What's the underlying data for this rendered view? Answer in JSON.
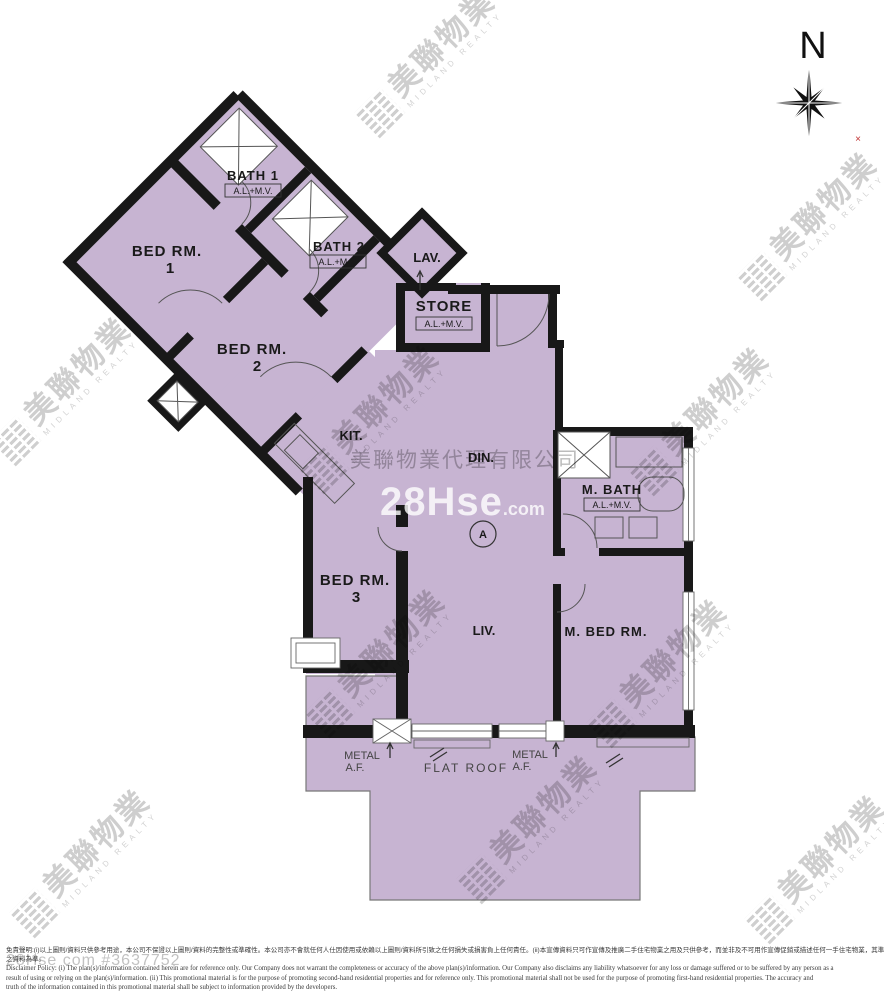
{
  "colors": {
    "floor_fill": "#c7b4d2",
    "wall": "#181818",
    "thin_line": "#555555",
    "watermark_gray": "#c6c6c6"
  },
  "compass": {
    "north_label": "N",
    "corner_mark": "×"
  },
  "rooms": {
    "bed1": {
      "name": "BED RM.",
      "number": "1"
    },
    "bed2": {
      "name": "BED RM.",
      "number": "2"
    },
    "bed3": {
      "name": "BED RM.",
      "number": "3"
    },
    "bath1": {
      "name": "BATH 1",
      "vent": "A.L.+M.V."
    },
    "bath2": {
      "name": "BATH 2",
      "vent": "A.L.+M.V."
    },
    "lav": {
      "name": "LAV."
    },
    "store": {
      "name": "STORE",
      "vent": "A.L.+M.V."
    },
    "kitchen": {
      "name": "KIT."
    },
    "dining": {
      "name": "DIN."
    },
    "living": {
      "name": "LIV."
    },
    "master_bath": {
      "name": "M. BATH",
      "vent": "A.L.+M.V."
    },
    "master_bed": {
      "name": "M. BED RM."
    },
    "flat_roof": {
      "name": "FLAT ROOF"
    },
    "metal_af_left": {
      "line1": "METAL",
      "line2": "A.F."
    },
    "metal_af_right": {
      "line1": "METAL",
      "line2": "A.F."
    },
    "unit_marker": "A"
  },
  "watermarks": {
    "midland_cn": "美聯物業",
    "midland_en": "MIDLAND REALTY",
    "company_full": "美聯物業代理有限公司",
    "site_brand": "28Hse",
    "site_brand_suffix": ".com",
    "listing_ref": "28Hse com #3637752"
  },
  "disclaimer": {
    "zh_line1": "免責聲明:(i)以上圖則/資料只供參考用途，本公司不保證以上圖則/資料的完整性或準確性。本公司亦不會就任何人仕因使用或依賴以上圖則/資料所引致之任何損失或損害負上任何責任。(ii)本宣傳資料只可作宣傳及推廣二手住宅物業之用及只供參考，而並非及不可用作宣傳促銷或描述任何一手住宅物業，其準確性及真實性以發展商提供",
    "zh_line2": "之資料為準。",
    "en_line1": "Disclaimer Policy: (i) The plan(s)/information contained herein are for reference only. Our Company does not warrant the completeness or accuracy of the above plan(s)/information. Our Company also disclaims any liability whatsoever for any loss or damage suffered or to be suffered by any person as a",
    "en_line2": "result of using or relying on the plan(s)/information. (ii) This promotional material is for the purpose of promoting second-hand residential properties and for reference only. This promotional material shall not be used for the purpose of promoting first-hand residential properties. The accuracy and",
    "en_line3": "truth of the information contained in this promotional material shall be subject to information provided by the developers."
  }
}
